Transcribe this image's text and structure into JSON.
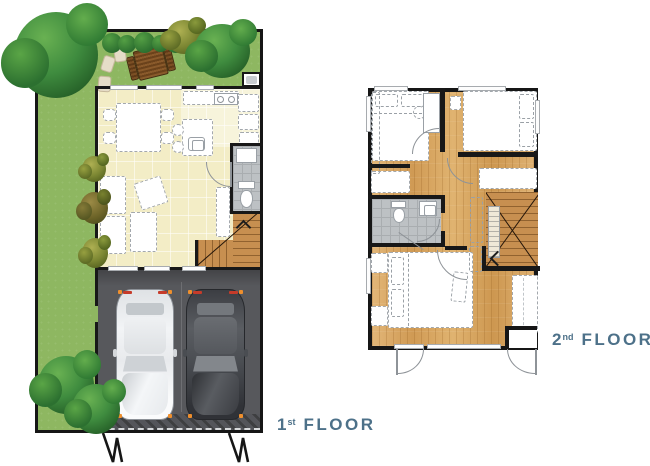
{
  "labels": {
    "first_floor": {
      "number": "1",
      "ordinal": "st",
      "word": "FLOOR"
    },
    "second_floor": {
      "number": "2",
      "ordinal": "nd",
      "word": "FLOOR"
    }
  },
  "palette": {
    "lawn_green": "#8eb761",
    "tree_green": "#2f7a33",
    "wall_black": "#181818",
    "interior_cream": "#f3edc6",
    "bath_tile_gray": "#bdc1c4",
    "garage_gray": "#56575b",
    "driveway_hatch": "#3e3f41",
    "stair_wood": "#c78f50",
    "second_floor_wood": "#dcab69",
    "furniture_outline": "#a3a8ad",
    "label_slate_blue": "#4d7189",
    "car_light": "#eef0f2",
    "car_dark": "#4b4e53",
    "accent_orange": "#ef8f2d",
    "accent_red": "#c63b2a"
  },
  "plans": {
    "first_floor": {
      "features": [
        "garden-lawn",
        "trees",
        "hedge",
        "patio-table",
        "stepping-stones",
        "living-area",
        "dining-table",
        "kitchen-counter",
        "kitchen-island",
        "bathroom",
        "staircase",
        "garage",
        "two-parked-cars",
        "driveway",
        "gate-marks"
      ]
    },
    "second_floor": {
      "features": [
        "bedroom-left",
        "bedroom-right",
        "desk",
        "bathroom",
        "staircase",
        "master-bedroom",
        "wardrobe",
        "balcony-doors",
        "porch"
      ]
    }
  }
}
